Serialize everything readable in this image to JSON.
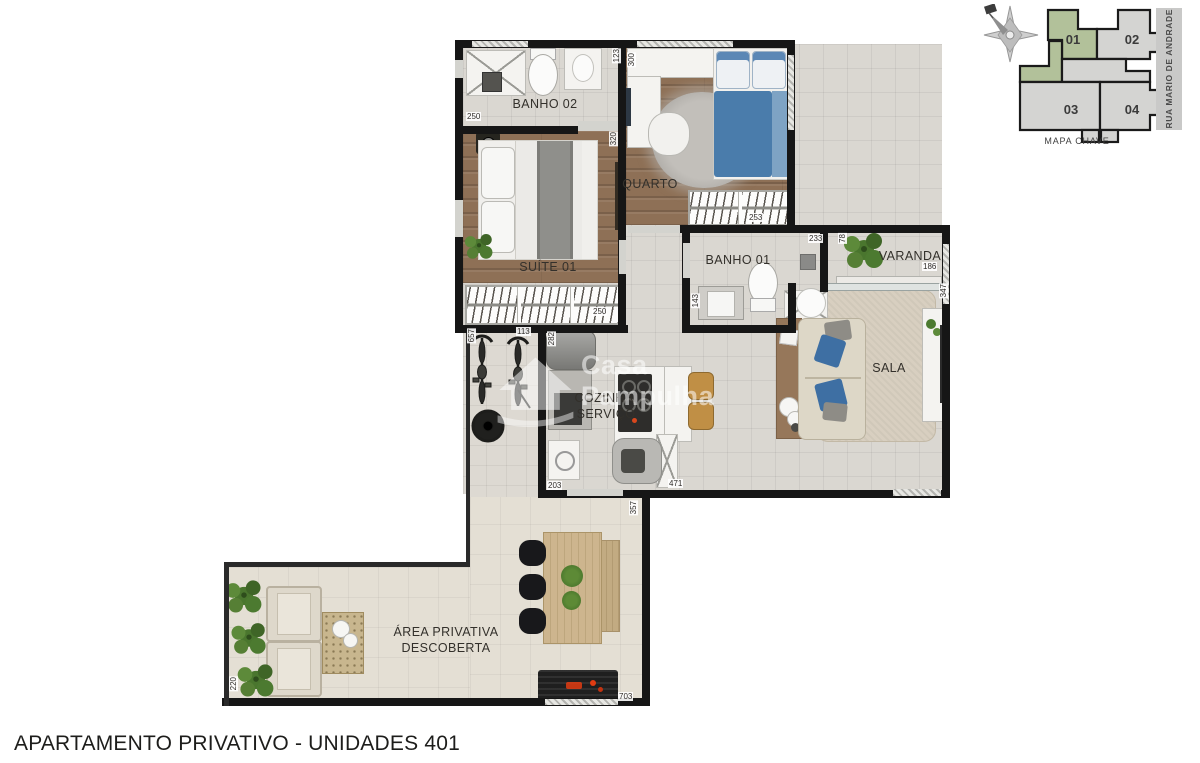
{
  "footer": {
    "title": "APARTAMENTO PRIVATIVO - UNIDADES 401"
  },
  "watermark": {
    "line1": "Casa",
    "line2": "Pampulha"
  },
  "key_map": {
    "caption": "MAPA CHAVE",
    "street": "RUA MARIO DE ANDRADE",
    "units": {
      "u01": "01",
      "u02": "02",
      "u03": "03",
      "u04": "04"
    },
    "highlight_color": "#b2c19a"
  },
  "plan": {
    "rooms": {
      "banho02": "BANHO 02",
      "quarto": "QUARTO",
      "suite01": "SUÍTE 01",
      "banho01": "BANHO 01",
      "varanda": "VARANDA",
      "sala": "SALA",
      "cozinha_line1": "COZINHA/",
      "cozinha_line2": "SERVIÇO",
      "area_line1": "ÁREA PRIVATIVA",
      "area_line2": "DESCOBERTA"
    },
    "dims": {
      "banho02_w": "250",
      "banho02_depth": "123",
      "quarto_w": "300",
      "suite_wall": "320",
      "quarto_closet": "253",
      "banho01_top": "233",
      "varanda_left": "78",
      "varanda_w": "186",
      "sala_right": "347",
      "suite_closet": "250",
      "bikes_h": "657",
      "bikes_w": "113",
      "kitchen_top": "282",
      "banho01_h": "143",
      "kitchen_bl": "203",
      "kitchen_br": "471",
      "terrace_r": "357",
      "terrace_b": "703",
      "terrace_l": "220"
    },
    "colors": {
      "wall": "#161616",
      "wood": "#8e7056",
      "tile": "#dad7d1",
      "terrace": "#e4dfd4"
    }
  }
}
